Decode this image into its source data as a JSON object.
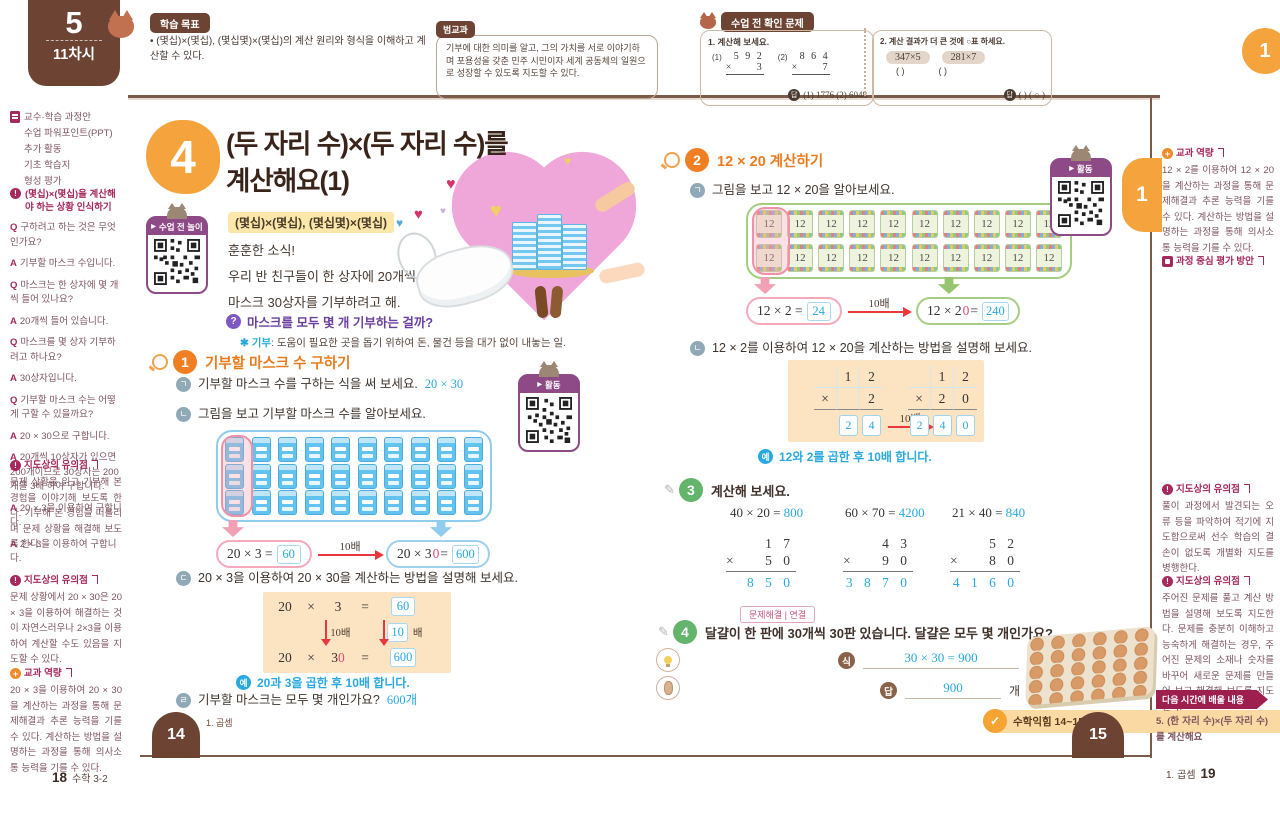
{
  "badge": {
    "number": "5",
    "session": "11차시"
  },
  "goal": {
    "label": "학습 목표",
    "text": "• (몇십)×(몇십), (몇십몇)×(몇십)의 계산 원리와 형식을 이해하고 계산할 수 있다."
  },
  "cross": {
    "label": "범교과",
    "text": "기부에 대한 의미를 알고, 그의 가치를 서로 이야기하며 포용성을 갖춘 민주 시민이자 세계 공동체의 일원으로 성장할 수 있도록 지도할 수 있다."
  },
  "check": {
    "label": "수업 전 확인 문제",
    "q1_title": "1. 계산해 보세요.",
    "q1": [
      {
        "idx": "(1)",
        "top": "5 9 2",
        "op": "×",
        "bot": "3"
      },
      {
        "idx": "(2)",
        "top": "8 6 4",
        "op": "×",
        "bot": "7"
      }
    ],
    "q1_answer_label": "답",
    "q1_answer": "(1) 1776  (2) 6048",
    "q2_title": "2. 계산 결과가 더 큰 것에 ○표 하세요.",
    "q2_chips": [
      "347×5",
      "281×7"
    ],
    "q2_paren1": "(      )",
    "q2_paren2": "(      )",
    "q2_answer_label": "답",
    "q2_answer": "(      ) ( ○ )"
  },
  "corner_tab": "1",
  "sidebarL": {
    "resources": [
      "교수·학습 과정안",
      "수업 파워포인트(PPT)",
      "추가 활동",
      "기초 학습지",
      "형성 평가"
    ],
    "q_label": "Q",
    "a_label": "A",
    "qa_badge": "?",
    "qa_title": "(몇십)×(몇십)을 계산해야 하는 상황 인식하기",
    "qa": [
      {
        "q": "구하려고 하는 것은 무엇인가요?",
        "a": [
          "기부할 마스크 수입니다."
        ]
      },
      {
        "q": "마스크는 한 상자에 몇 개씩 들어 있나요?",
        "a": [
          "20개씩 들어 있습니다."
        ]
      },
      {
        "q": "마스크를 몇 상자 기부하려고 하나요?",
        "a": [
          "30상자입니다."
        ]
      },
      {
        "q": "기부할 마스크 수는 어떻게 구할 수 있을까요?",
        "a": [
          "20 × 30으로 구합니다.",
          "20개씩 10상자가 있으면 200개이므로 30상자는 200개를 3배 하여 구합니다.",
          "20 × 3을 이용하여 구합니다.",
          "2 × 3을 이용하여 구합니다."
        ]
      }
    ],
    "note1_label": "지도상의 유의점",
    "note1": "문제 상황을 읽고 기부해 본 경험을 이야기해 보도록 한다. 기부해 본 경험을 떠올리며 문제 상황을 해결해 보도록 한다.",
    "note2_label": "지도상의 유의점",
    "note2": "문제 상황에서 20 × 30은 20 × 3을 이용하여 해결하는 것이 자연스러우나 2×3을 이용하여 계산할 수도 있음을 지도할 수 있다.",
    "comp_label": "교과 역량",
    "comp": "20 × 3을 이용하여 20 × 30을 계산하는 과정을 통해 문제해결과 추론 능력을 기를 수 있다. 계산하는 방법을 설명하는 과정을 통해 의사소통 능력을 기를 수 있다.",
    "footer_page": "18",
    "footer_book": "수학 3-2"
  },
  "p14": {
    "lesson_no": "4",
    "title1": "(두 자리 수)×(두 자리 수)를",
    "title2": "계산해요(1)",
    "subtitle": "(몇십)×(몇십), (몇십몇)×(몇십)",
    "qr_play": "수업 전 놀이",
    "story": [
      "훈훈한 소식!",
      "우리 반 친구들이 한 상자에 20개씩 들어 있는",
      "마스크 30상자를 기부하려고 해."
    ],
    "question": "마스크를 모두 몇 개 기부하는 걸까?",
    "fn_star": "✱",
    "fn_term": "기부",
    "fn_text": ": 도움이 필요한 곳을 돕기 위하여 돈, 물건 등을 대가 없이 내놓는 일.",
    "act1_no": "1",
    "act1_title": "기부할 마스크 수 구하기",
    "item_a_marker": "ㄱ",
    "item_a": "기부할 마스크 수를 구하는 식을 써 보세요.",
    "item_a_ans": "20 × 30",
    "item_b_marker": "ㄴ",
    "item_b": "그림을 보고 기부할 마스크 수를 알아보세요.",
    "mask_grid": {
      "rows": 3,
      "cols": 10
    },
    "eq_left": "20 × 3 =",
    "eq_left_ans": "60",
    "times": "10배",
    "eq_right_pre": "20 × 3",
    "eq_right_zero": "0",
    "eq_right_eq": " =",
    "eq_right_ans": "600",
    "item_c_marker": "ㄷ",
    "item_c": "20 × 3을 이용하여 20 × 30을 계산하는 방법을 설명해 보세요.",
    "steps": {
      "a1": "20",
      "x1": "×",
      "b1": "3",
      "e1": "=",
      "r1": "60",
      "down": "10배",
      "factor": "10",
      "factor_suffix": "배",
      "a2": "20",
      "x2": "×",
      "b2": "3",
      "z2": "0",
      "e2": "=",
      "r2": "600"
    },
    "ex_badge": "예",
    "example": "20과 3을 곱한 후 10배 합니다.",
    "item_d_marker": "ㄹ",
    "item_d": "기부할 마스크는 모두 몇 개인가요?",
    "item_d_ans": "600개",
    "qr_act": "활동",
    "tab": "14",
    "unit": "1. 곱셈"
  },
  "p15": {
    "act2_no": "2",
    "act2_title": "12 × 20 계산하기",
    "item_a_marker": "ㄱ",
    "item_a": "그림을 보고 12 × 20을 알아보세요.",
    "crayon_grid": {
      "rows": 2,
      "cols": 10,
      "label": "12"
    },
    "eq_left": "12 × 2 =",
    "eq_left_ans": "24",
    "times": "10배",
    "eq_right_pre": "12 × 2",
    "eq_right_zero": "0",
    "eq_right_eq": " =",
    "eq_right_ans": "240",
    "item_b_marker": "ㄴ",
    "item_b": "12 × 2를 이용하여 12 × 20을 계산하는 방법을 설명해 보세요.",
    "vmul_left": {
      "t1": "1",
      "t2": "2",
      "op": "×",
      "b2": "2",
      "r1": "2",
      "r2": "4"
    },
    "vmul_right": {
      "t1": "1",
      "t2": "2",
      "op": "×",
      "b1": "2",
      "b2": "0",
      "r1": "2",
      "r2": "4",
      "r3": "0"
    },
    "vmul_times": "10배",
    "ex_badge": "예",
    "example": "12와 2를 곱한 후 10배 합니다.",
    "act3_no": "3",
    "act3_title": "계산해 보세요.",
    "eqs": [
      {
        "e": "40 × 20 =",
        "a": "800"
      },
      {
        "e": "60 × 70 =",
        "a": "4200"
      },
      {
        "e": "21 × 40 =",
        "a": "840"
      }
    ],
    "cols": [
      {
        "top": "1 7",
        "op": "×",
        "bot": "5 0",
        "ans": "8 5 0"
      },
      {
        "top": "4 3",
        "op": "×",
        "bot": "9 0",
        "ans": "3 8 7 0"
      },
      {
        "top": "5 2",
        "op": "×",
        "bot": "8 0",
        "ans": "4 1 6 0"
      }
    ],
    "act4_no": "4",
    "act4_tag": "문제해결 | 연결",
    "act4_text": "달걀이 한 판에 30개씩 30판 있습니다. 달걀은 모두 몇 개인가요?",
    "eq_label": "식",
    "eq_value": "30 × 30 = 900",
    "ans_label": "답",
    "ans_value": "900",
    "ans_unit": "개",
    "workbook": "수학익힘 14~15쪽",
    "qr_act": "활동",
    "side_tab": "1",
    "tab": "15"
  },
  "sidebarR": {
    "comp_label": "교과 역량",
    "comp": "12 × 2를 이용하여 12 × 20을 계산하는 과정을 통해 문제해결과 추론 능력을 기를 수 있다. 계산하는 방법을 설명하는 과정을 통해 의사소통 능력을 기를 수 있다.",
    "assess_label": "과정 중심 평가 방안",
    "note1_label": "지도상의 유의점",
    "note1": "풀이 과정에서 발견되는 오류 등을 파악하여 적기에 지도함으로써 선수 학습의 결손이 없도록 개별화 지도를 병행한다.",
    "note2_label": "지도상의 유의점",
    "note2": "주어진 문제를 풀고 계산 방법을 설명해 보도록 지도한다. 문제를 충분히 이해하고 능숙하게 해결하는 경우, 주어진 문제의 소재나 숫자를 바꾸어 새로운 문제를 만들어 보고 해결해 보도록 지도한다.",
    "next_label": "다음 시간에 배울 내용",
    "next": "5. (한 자리 수)×(두 자리 수)를 계산해요",
    "footer_unit": "1. 곱셈",
    "footer_page": "19"
  }
}
